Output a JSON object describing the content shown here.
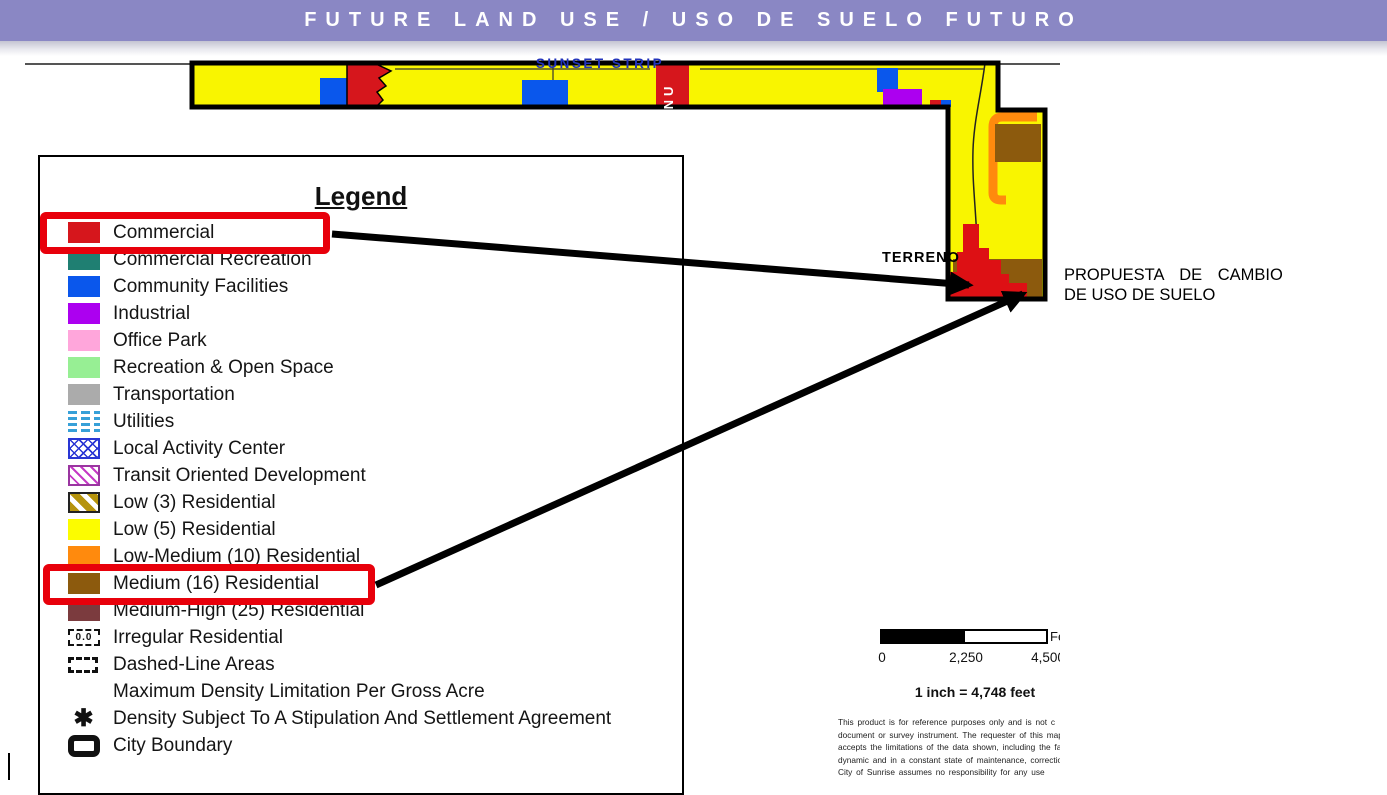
{
  "header": {
    "title": "FUTURE LAND USE / USO DE SUELO FUTURO"
  },
  "map": {
    "street_label": "SUNSET STRIP",
    "road_label": "NU",
    "terreno_label": "TERRENO"
  },
  "annotation": {
    "line1": "PROPUESTA DE CAMBIO",
    "line2": "DE USO DE SUELO"
  },
  "legend": {
    "title": "Legend",
    "items": [
      {
        "label": "Commercial",
        "swatch": "solid",
        "color": "#D6161C",
        "highlighted": true
      },
      {
        "label": "Commercial Recreation",
        "swatch": "solid",
        "color": "#1F7F72"
      },
      {
        "label": "Community Facilities",
        "swatch": "solid",
        "color": "#0A57EC"
      },
      {
        "label": "Industrial",
        "swatch": "solid",
        "color": "#AC00F0"
      },
      {
        "label": "Office Park",
        "swatch": "solid",
        "color": "#FFA6DB"
      },
      {
        "label": "Recreation & Open Space",
        "swatch": "solid",
        "color": "#97EF94"
      },
      {
        "label": "Transportation",
        "swatch": "solid",
        "color": "#ABABAB"
      },
      {
        "label": "Utilities",
        "swatch": "utilities"
      },
      {
        "label": "Local Activity Center",
        "swatch": "lac"
      },
      {
        "label": "Transit Oriented Development",
        "swatch": "tod"
      },
      {
        "label": "Low (3) Residential",
        "swatch": "low3",
        "color": "#B6940D"
      },
      {
        "label": "Low (5) Residential",
        "swatch": "solid",
        "color": "#FCFC00"
      },
      {
        "label": "Low-Medium (10) Residential",
        "swatch": "solid",
        "color": "#FF8A0D"
      },
      {
        "label": "Medium (16) Residential",
        "swatch": "solid",
        "color": "#8C5A0D",
        "highlighted": true
      },
      {
        "label": "Medium-High (25) Residential",
        "swatch": "solid",
        "color": "#7B3B3E"
      },
      {
        "label": "Irregular Residential",
        "swatch": "irregular",
        "icon_text": "0.0"
      },
      {
        "label": "Dashed-Line Areas",
        "swatch": "dashed"
      },
      {
        "label": "Maximum Density Limitation Per Gross Acre",
        "swatch": "none"
      },
      {
        "label": "Density Subject To A Stipulation And Settlement Agreement",
        "swatch": "asterisk",
        "icon_text": "✱"
      },
      {
        "label": "City Boundary",
        "swatch": "cityboundary"
      }
    ]
  },
  "scalebar": {
    "ticks": [
      "0",
      "2,250",
      "4,500"
    ],
    "unit_label": "Feet",
    "scale_text": "1 inch = 4,748 feet"
  },
  "disclaimer": {
    "lines": [
      "This product is for reference purposes only and is not c",
      "document or survey instrument. The requester of this map",
      "accepts the limitations of the data shown, including the fa",
      "dynamic and in a constant state of maintenance, correction",
      "City of Sunrise assumes no responsibility for any use"
    ]
  },
  "colors": {
    "header_bg": "#8A87C4",
    "map_yellow": "#F9F500",
    "commercial_red": "#D6161C",
    "highlight_red": "#E8000B",
    "medium16_brown": "#8C5A0D",
    "low_medium_orange": "#FF8A0D",
    "community_blue": "#0A57EC",
    "industrial_violet": "#AC00F0"
  }
}
